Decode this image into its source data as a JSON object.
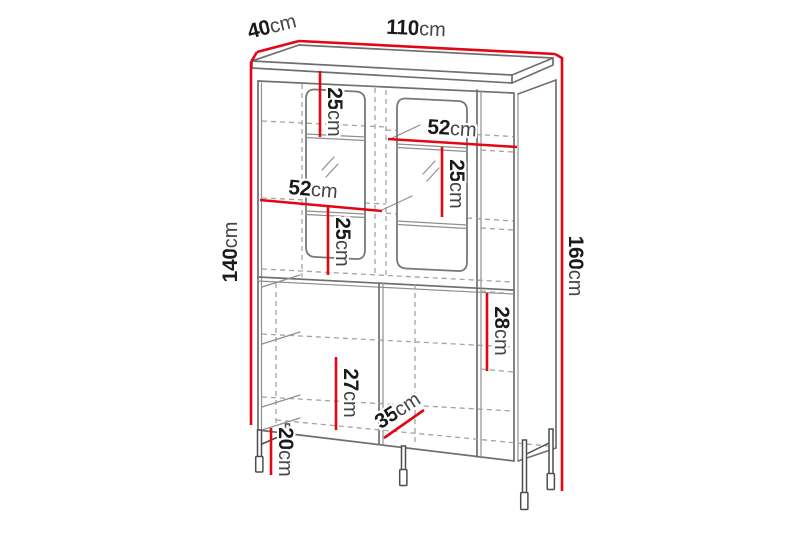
{
  "diagram": {
    "kind": "furniture dimension drawing",
    "unit": "cm"
  },
  "dimensions": [
    {
      "id": "width-top",
      "value": "110",
      "unit": "cm"
    },
    {
      "id": "depth-top",
      "value": "40",
      "unit": "cm"
    },
    {
      "id": "height-body-left",
      "value": "140",
      "unit": "cm"
    },
    {
      "id": "height-total-right",
      "value": "160",
      "unit": "cm"
    },
    {
      "id": "shelf-top-left",
      "value": "25",
      "unit": "cm"
    },
    {
      "id": "inner-width-right",
      "value": "52",
      "unit": "cm"
    },
    {
      "id": "shelf-right",
      "value": "25",
      "unit": "cm"
    },
    {
      "id": "inner-width-left",
      "value": "52",
      "unit": "cm"
    },
    {
      "id": "shelf-left",
      "value": "25",
      "unit": "cm"
    },
    {
      "id": "shelf-lower-right",
      "value": "28",
      "unit": "cm"
    },
    {
      "id": "shelf-lower-left",
      "value": "27",
      "unit": "cm"
    },
    {
      "id": "depth-bottom",
      "value": "35",
      "unit": "cm"
    },
    {
      "id": "leg-height",
      "value": "20",
      "unit": "cm"
    }
  ],
  "colors": {
    "dimension_line": "#e30613",
    "structure_line": "#6f6f6f",
    "hidden_line": "#a3a3a3",
    "background": "#ffffff",
    "text": "#1a1a1a"
  }
}
